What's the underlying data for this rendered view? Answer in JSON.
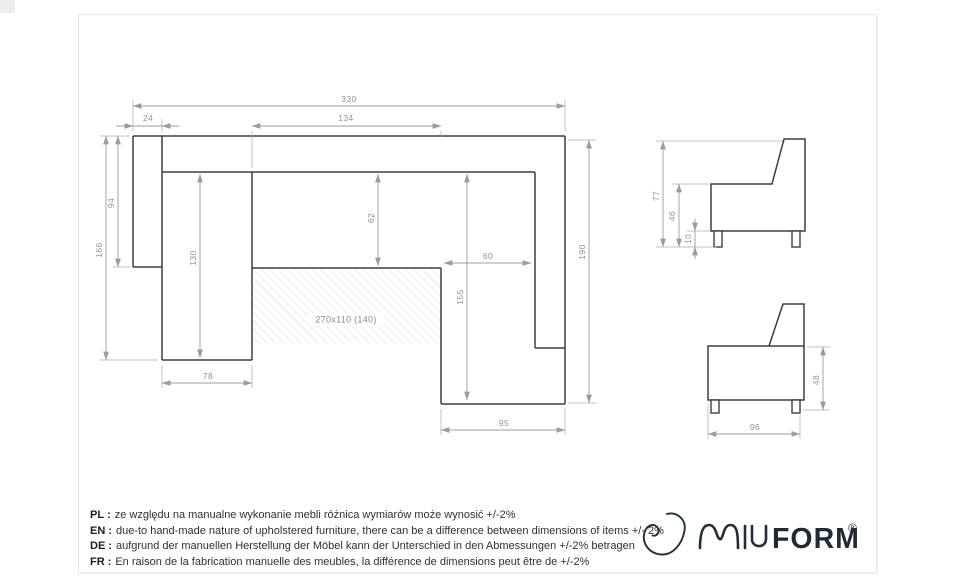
{
  "drawing": {
    "plan": {
      "dims": {
        "overall_width": "330",
        "left_armrest_width": "24",
        "center_section_width": "134",
        "left_armrest_depth": "94",
        "left_side_depth": "166",
        "left_chaise_length": "130",
        "seat_depth": "62",
        "right_seat_width": "60",
        "right_chaise_length": "155",
        "right_side_depth": "190",
        "left_chaise_width": "78",
        "right_chaise_width": "95"
      },
      "sleeping_area_label": "270x110 (140)"
    },
    "side_view_corner": {
      "dims": {
        "total_height": "77",
        "seat_height": "46",
        "leg_height": "10"
      }
    },
    "side_view_front": {
      "dims": {
        "body_height": "48",
        "depth": "96"
      }
    }
  },
  "disclaimers": [
    {
      "lang": "PL",
      "text": "ze względu na manualne wykonanie mebli różnica wymiarów może wynosić +/-2%"
    },
    {
      "lang": "EN",
      "text": "due-to hand-made nature of upholstered furniture, there can be a difference between dimensions of items +/- 2%"
    },
    {
      "lang": "DE",
      "text": "aufgrund der manuellen Herstellung der Möbel kann der Unterschied in den Abmessungen +/-2% betragen"
    },
    {
      "lang": "FR",
      "text": "En raison de la fabrication manuelle des meubles, la différence de dimensions peut être de +/-2%"
    }
  ],
  "separator": ":",
  "logo": {
    "brand": "MIUFORM",
    "graphic_letters": "MIU",
    "text_letters": "FORM",
    "registered": "®"
  },
  "colors": {
    "outline": "#3e3e3e",
    "dimension_line": "#9c9c9c",
    "dimension_text": "#8f8f8f",
    "hatch": "#dcdcdc",
    "frame_border": "#e7e7e7",
    "logo_navy": "#1e2a36"
  }
}
